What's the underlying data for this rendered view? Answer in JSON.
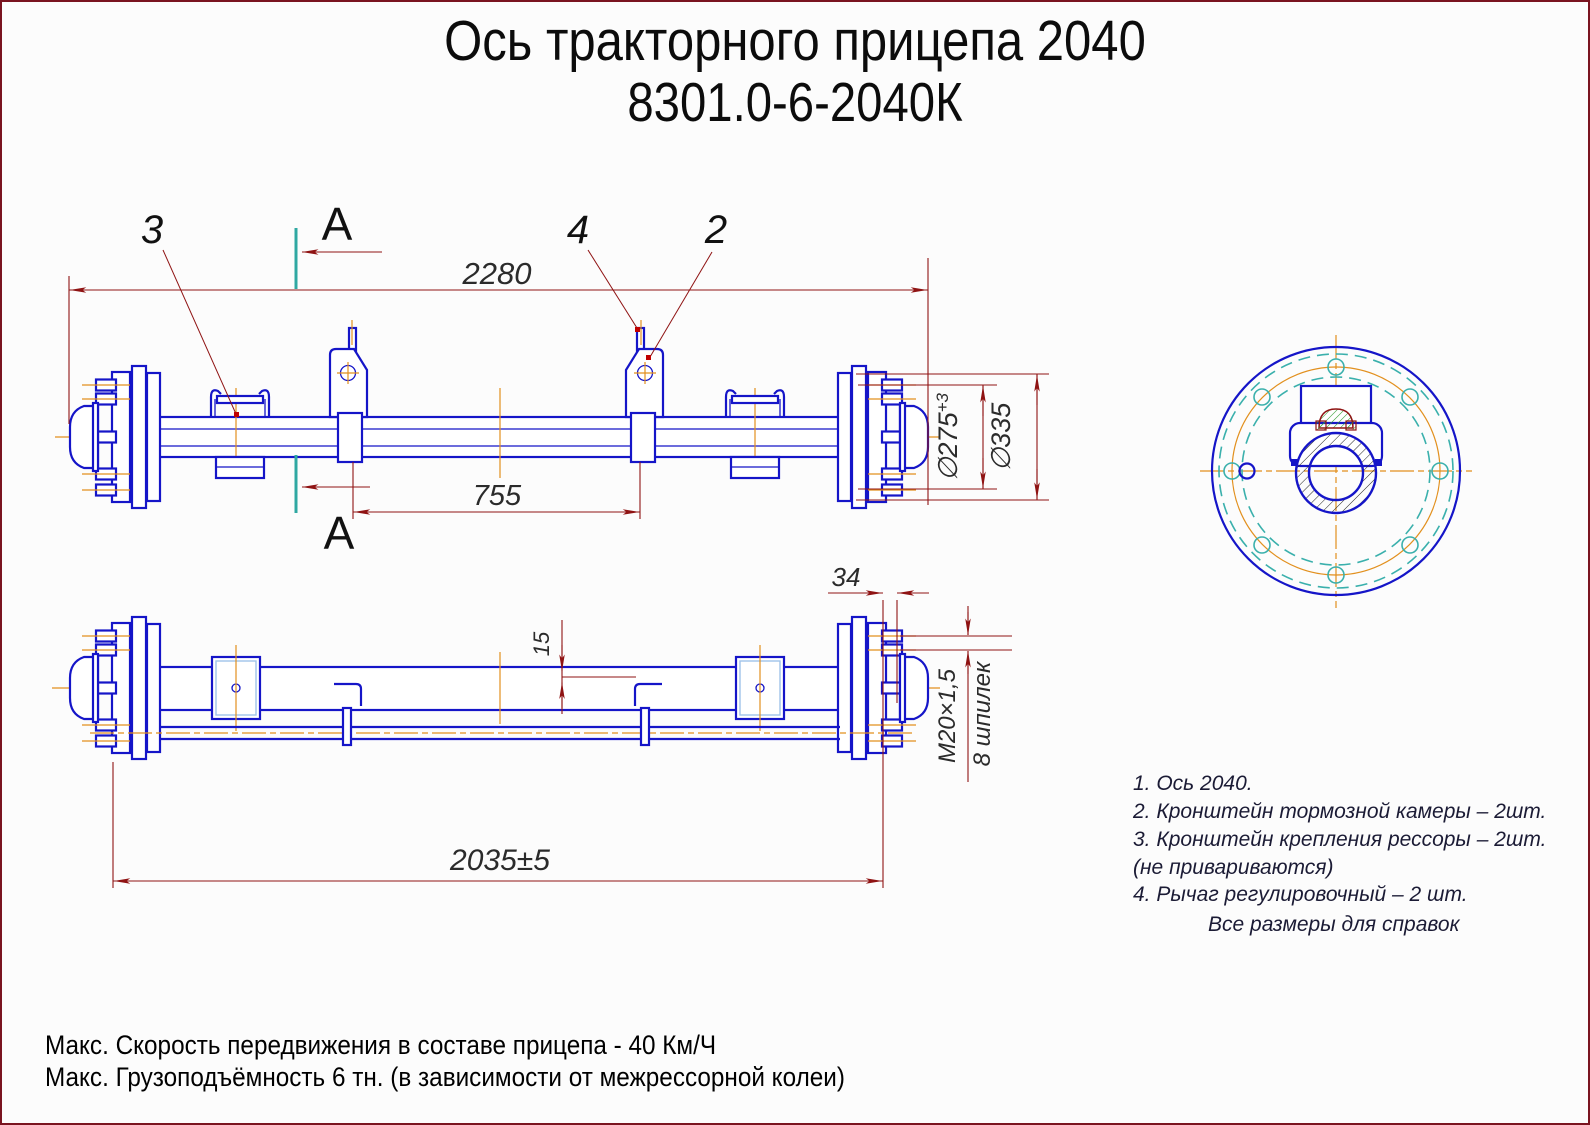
{
  "title": {
    "line1": "Ось тракторного прицепа 2040",
    "line2": "8301.0-6-2040К"
  },
  "section_label": "А",
  "callouts": {
    "n2": "2",
    "n3": "3",
    "n4": "4"
  },
  "dims": {
    "overall": "2280",
    "levers_span": "755",
    "hub_span": "2035±5",
    "stud_proj": "34",
    "rod_offset": "15",
    "bolt_circle": "∅275",
    "bolt_circle_tol": "+3",
    "flange": "∅335",
    "thread": "М20×1,5",
    "stud_count": "8 шпилек"
  },
  "notes": [
    "1. Ось 2040.",
    "2. Кронштейн тормозной камеры – 2шт.",
    "3. Кронштейн крепления рессоры – 2шт.",
    "(не привариваются)",
    "4. Рычаг регулировочный – 2 шт."
  ],
  "notes_footer": "Все размеры для справок",
  "specs": {
    "speed": "Макс. Скорость передвижения в составе прицепа - 40 Км/Ч",
    "capacity": "Макс. Грузоподъёмность 6 тн. (в зависимости от межрессорной колеи)"
  },
  "colors": {
    "line_blue": "#1515c8",
    "dim_red": "#8f1313",
    "section_teal": "#2fa8a2",
    "centerline_orange": "#e2901e",
    "marker_red": "#c00000",
    "hatch_green": "#2f9b2f",
    "border": "#7a1420"
  }
}
